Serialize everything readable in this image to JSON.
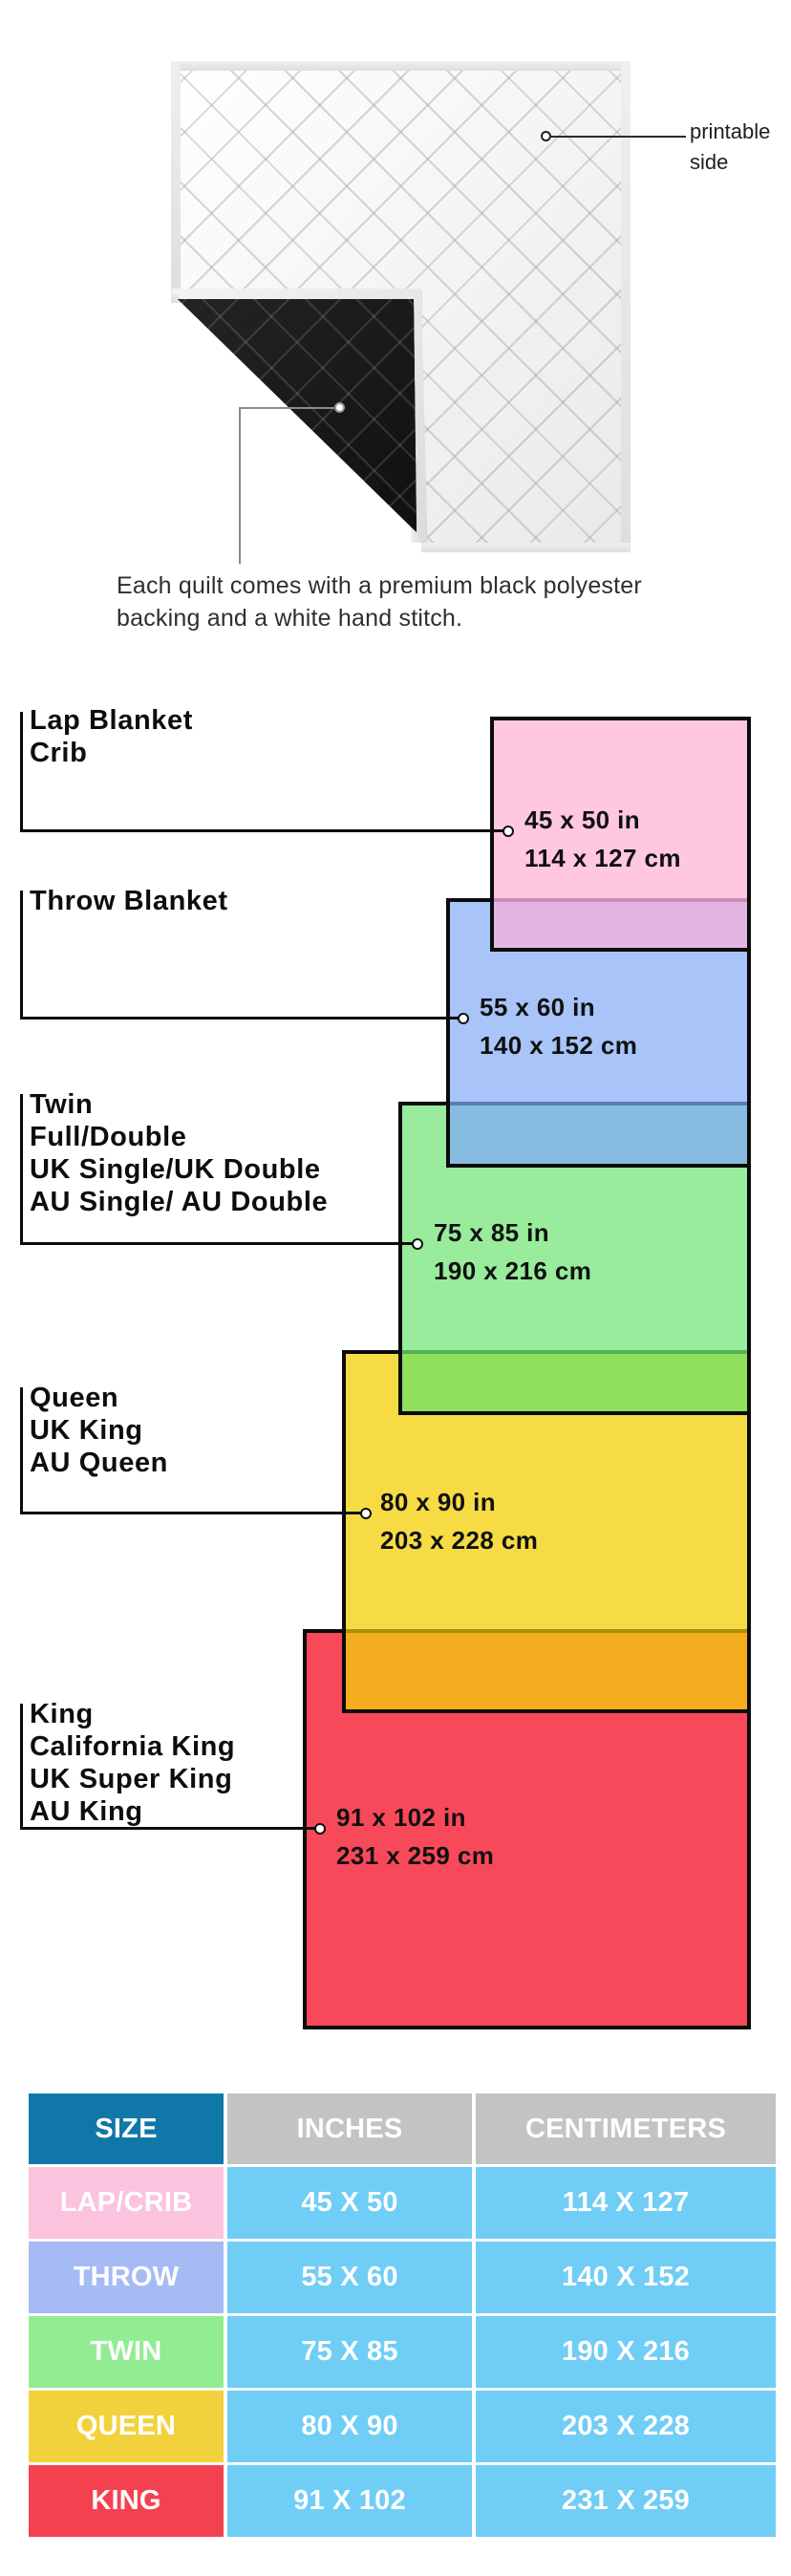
{
  "hero": {
    "printable_label_line1": "printable",
    "printable_label_line2": "side",
    "caption_line1": "Each quilt comes with a premium black polyester",
    "caption_line2": "backing and a white hand stitch."
  },
  "diagram": {
    "blankets": [
      {
        "names": [
          "Lap Blanket",
          "Crib"
        ],
        "inches": "45 x 50 in",
        "cm": "114 x 127 cm",
        "fill": "#FFC8E0",
        "overlap_fill": "#E3B6E2",
        "overlap_line": "#C78FB8"
      },
      {
        "names": [
          "Throw Blanket"
        ],
        "inches": "55 x 60 in",
        "cm": "140 x 152 cm",
        "fill": "#A8C4F8",
        "overlap_fill": "#85BCE0",
        "overlap_line": "#5B7FB5"
      },
      {
        "names": [
          "Twin",
          "Full/Double",
          "UK Single/UK Double",
          "AU Single/ AU Double"
        ],
        "inches": "75 x 85 in",
        "cm": "190 x 216 cm",
        "fill": "#98EC9B",
        "overlap_fill": "#8FE05A",
        "overlap_line": "#55B152"
      },
      {
        "names": [
          "Queen",
          "UK King",
          "AU Queen"
        ],
        "inches": "80 x 90 in",
        "cm": "203 x 228 cm",
        "fill": "#F6DB45",
        "overlap_fill": "#F4AD1E",
        "overlap_line": "#A8900A"
      },
      {
        "names": [
          "King",
          "California King",
          "UK Super King",
          "AU King"
        ],
        "inches": "91 x 102 in",
        "cm": "231 x 259 cm",
        "fill": "#F8495A",
        "overlap_fill": null,
        "overlap_line": null
      }
    ]
  },
  "table": {
    "headers": [
      "SIZE",
      "INCHES",
      "CENTIMETERS"
    ],
    "header_size_bg": "#1078A8",
    "header_other_bg": "#C3C3C3",
    "value_cell_bg": "#70CDF6",
    "rows": [
      {
        "label": "LAP/CRIB",
        "inches": "45 X 50",
        "cm": "114 X 127",
        "label_bg": "#FBC3DD"
      },
      {
        "label": "THROW",
        "inches": "55 X 60",
        "cm": "140 X 152",
        "label_bg": "#A6BAF3"
      },
      {
        "label": "TWIN",
        "inches": "75 X 85",
        "cm": "190 X 216",
        "label_bg": "#92EC92"
      },
      {
        "label": "QUEEN",
        "inches": "80 X 90",
        "cm": "203 X 228",
        "label_bg": "#F2D23C"
      },
      {
        "label": "KING",
        "inches": "91 X 102",
        "cm": "231 X 259",
        "label_bg": "#F4414F"
      }
    ]
  }
}
